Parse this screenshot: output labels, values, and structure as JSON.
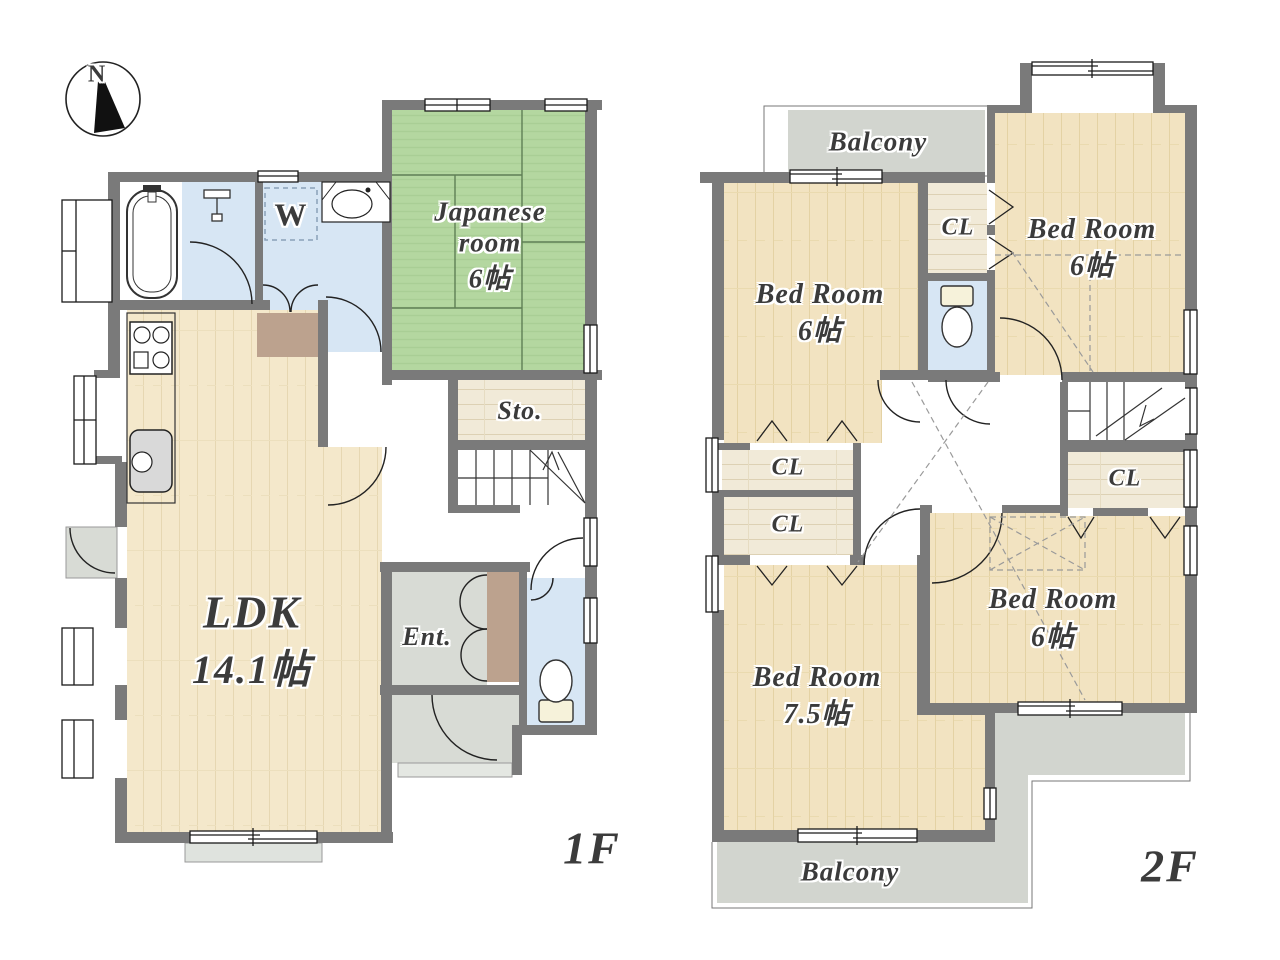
{
  "compass": {
    "north_label": "N"
  },
  "floor1": {
    "floor_label": "1F",
    "rooms": {
      "japanese_room": {
        "line1": "Japanese",
        "line2": "room",
        "size": "6帖"
      },
      "storage": {
        "label": "Sto."
      },
      "ldk": {
        "label": "LDK",
        "size": "14.1帖"
      },
      "entrance": {
        "label": "Ent."
      },
      "washer": {
        "label": "W"
      }
    }
  },
  "floor2": {
    "floor_label": "2F",
    "rooms": {
      "balcony_north": {
        "label": "Balcony"
      },
      "bedroom_northwest": {
        "label": "Bed Room",
        "size": "6帖"
      },
      "bedroom_northeast": {
        "label": "Bed Room",
        "size": "6帖"
      },
      "bedroom_southwest": {
        "label": "Bed Room",
        "size": "7.5帖"
      },
      "bedroom_southeast": {
        "label": "Bed Room",
        "size": "6帖"
      },
      "closet_north": {
        "label": "CL"
      },
      "closet_west_upper": {
        "label": "CL"
      },
      "closet_west_lower": {
        "label": "CL"
      },
      "closet_east": {
        "label": "CL"
      },
      "balcony_south": {
        "label": "Balcony"
      }
    }
  },
  "colors": {
    "wall": "#7a7a7a",
    "tatami": "#b4d7a0",
    "wood_ldk": "#f4e8cb",
    "wood_bedroom": "#f2e3c1",
    "closet_floor": "#f1ead8",
    "wet_area": "#d7e6f4",
    "entrance_floor": "#d8dbd5",
    "balcony_floor": "#d2d5cf",
    "hall_step": "#bca28e"
  }
}
